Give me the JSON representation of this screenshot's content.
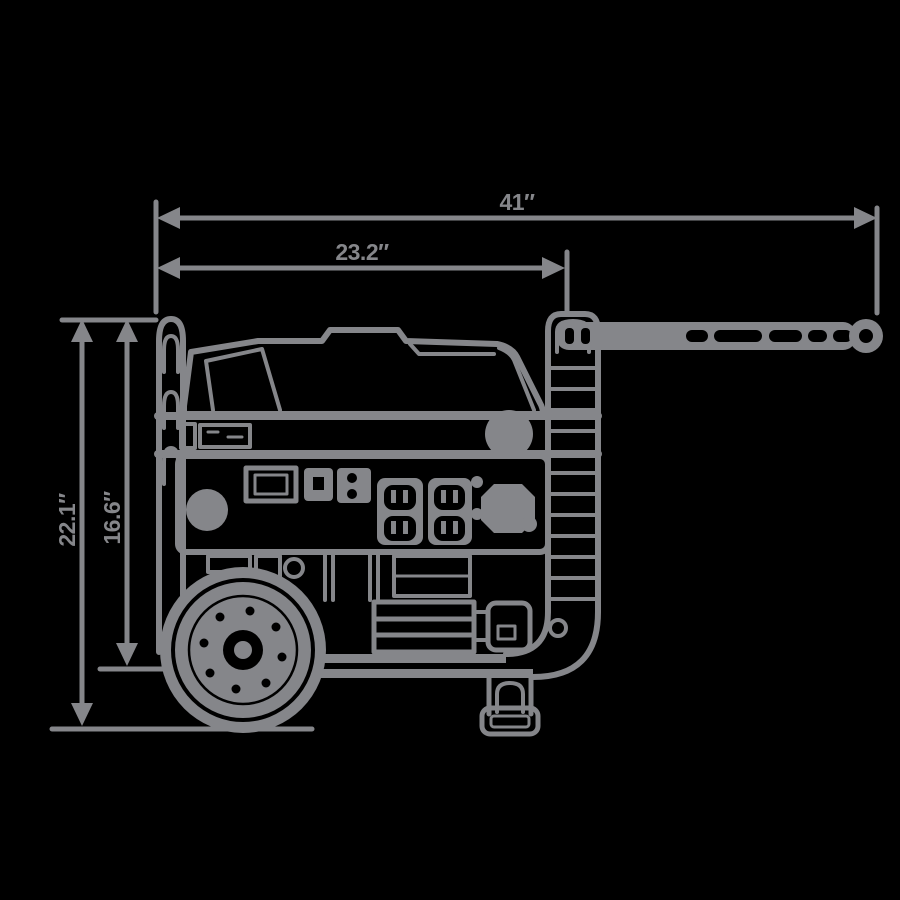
{
  "colors": {
    "background": "#000000",
    "line": "#85868a"
  },
  "labels": {
    "width_overall": "41″",
    "width_body": "23.2″",
    "height_overall": "22.1″",
    "height_body": "16.6″"
  }
}
